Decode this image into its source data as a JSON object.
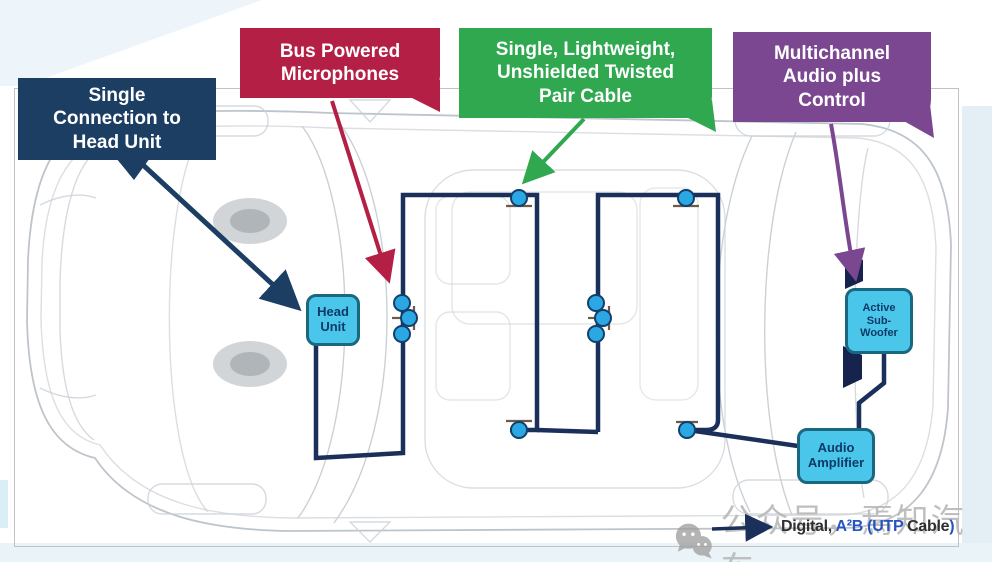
{
  "slide": {
    "callouts": [
      {
        "id": "single-connection-to-head-unit",
        "label": "Single\nConnection to\nHead Unit",
        "color": "#1c3e63"
      },
      {
        "id": "bus-powered-microphones",
        "label": "Bus Powered\nMicrophones",
        "color": "#b41f45"
      },
      {
        "id": "utp-cable",
        "label": "Single, Lightweight,\nUnshielded Twisted\nPair Cable",
        "color": "#2fa84f"
      },
      {
        "id": "multichannel-audio-plus-control",
        "label": "Multichannel\nAudio plus\nControl",
        "color": "#7b4790"
      }
    ],
    "components": [
      {
        "id": "head-unit",
        "label": "Head\nUnit"
      },
      {
        "id": "active-subwoofer",
        "label": "Active\nSub-\nWoofer"
      },
      {
        "id": "audio-amplifier",
        "label": "Audio\nAmplifier"
      }
    ],
    "legend": {
      "parts": [
        {
          "text": "Digital, ",
          "color": "#2f2f2f"
        },
        {
          "text": "A²B (UTP ",
          "color": "#2553c2"
        },
        {
          "text": "Cable",
          "color": "#2f2f2f"
        },
        {
          "text": ")",
          "color": "#2553c2"
        }
      ]
    },
    "watermark": {
      "icon": "wechat-icon",
      "text": "公众号，焉知汽车"
    },
    "colors": {
      "cable": "#1a2f5a",
      "node_fill": "#2ba7e3",
      "node_stroke": "#13406b",
      "component_fill": "#4ac6ea",
      "component_border": "#1a6880",
      "wireframe": "#c6ccd2"
    }
  }
}
